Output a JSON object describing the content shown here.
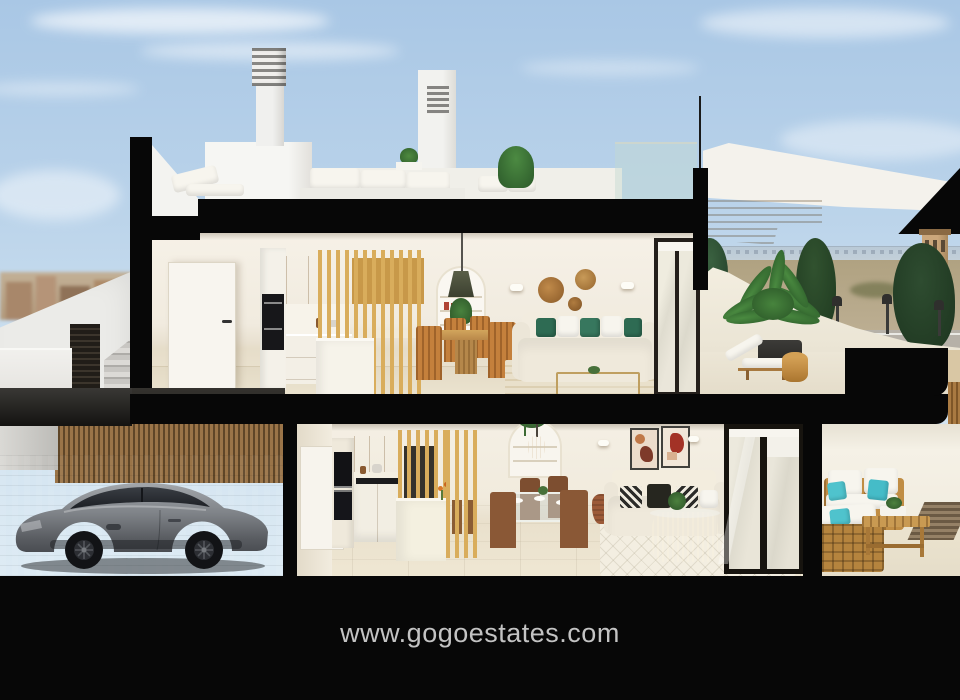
{
  "page": {
    "title": "Two-storey townhouse cutaway render"
  },
  "footer": {
    "website_url": "www.gogoestates.com"
  },
  "colors": {
    "sky_top": "#a9c7e5",
    "sky_bottom": "#ddebf4",
    "cutaway_black": "#070707",
    "wall_cream": "#f2ecdf",
    "floor_beige": "#e8dfcb",
    "wood_slat": "#d9ad5c",
    "wood_cabinet": "#cf9c46",
    "canopy_wood": "#c08438",
    "sofa_cream": "#efe9db",
    "pillow_green": "#2e6b53",
    "pillow_teal": "#4fc3cd",
    "plant_green": "#3e7a38",
    "car_body_gray": "#8b8f94",
    "pavement_gray": "#97989a",
    "fence_wood": "#9a7448",
    "footer_text": "#c3c3c3"
  },
  "scene": {
    "description": "Cross-section cutaway 3D render of a modern two-storey coastal townhouse with black cut edges, shown against a blue sky",
    "levels": [
      {
        "name": "rooftop-terrace",
        "features": [
          "louvered chimney vents",
          "white roof volumes",
          "outdoor lounge cushions",
          "potted plants",
          "glass railing"
        ]
      },
      {
        "name": "upper-floor",
        "rooms": [
          {
            "name": "kitchen",
            "features": [
              "white interior door",
              "built-in black oven",
              "wood upper cabinets",
              "white island",
              "timber slat partition"
            ]
          },
          {
            "name": "living-dining",
            "features": [
              "arched shelf niche",
              "dark pendant lamp",
              "round wood dining table",
              "four timber chairs",
              "cream sofa with green cushions",
              "three woven wall baskets",
              "two wall sconces",
              "gold-framed coffee table",
              "striped rug",
              "sliding glass door"
            ]
          },
          {
            "name": "terrace",
            "features": [
              "curved white parapet",
              "timber canopy soffit",
              "large potted palm",
              "timber sun lounger",
              "round timber side table",
              "sea horizon",
              "watchtower",
              "conifer trees",
              "street lamps"
            ]
          }
        ]
      },
      {
        "name": "ground-floor",
        "rooms": [
          {
            "name": "driveway",
            "features": [
              "grey sports coupe",
              "timber slat fence",
              "grey paved forecourt",
              "exterior staircase",
              "louvre vent panel",
              "distant town skyline"
            ]
          },
          {
            "name": "kitchen",
            "features": [
              "tall oven column",
              "wood upper cabinets",
              "black cooktop",
              "white island",
              "timber slat partitions"
            ]
          },
          {
            "name": "living-dining",
            "features": [
              "glass dining table with place settings",
              "brown timber chairs",
              "arched niche with hanging plant",
              "wire pendant lamp",
              "two abstract artworks",
              "cream sofa with monochrome patterned cushions",
              "rattan coffee table",
              "diamond-pattern rug",
              "terracotta vase",
              "dark-framed sliding glass doors"
            ]
          },
          {
            "name": "patio",
            "features": [
              "timber outdoor sofa set",
              "white outdoor cushions",
              "teal accent pillows",
              "timber coffee bench with plant tray",
              "striped outdoor rug"
            ]
          }
        ]
      }
    ]
  }
}
